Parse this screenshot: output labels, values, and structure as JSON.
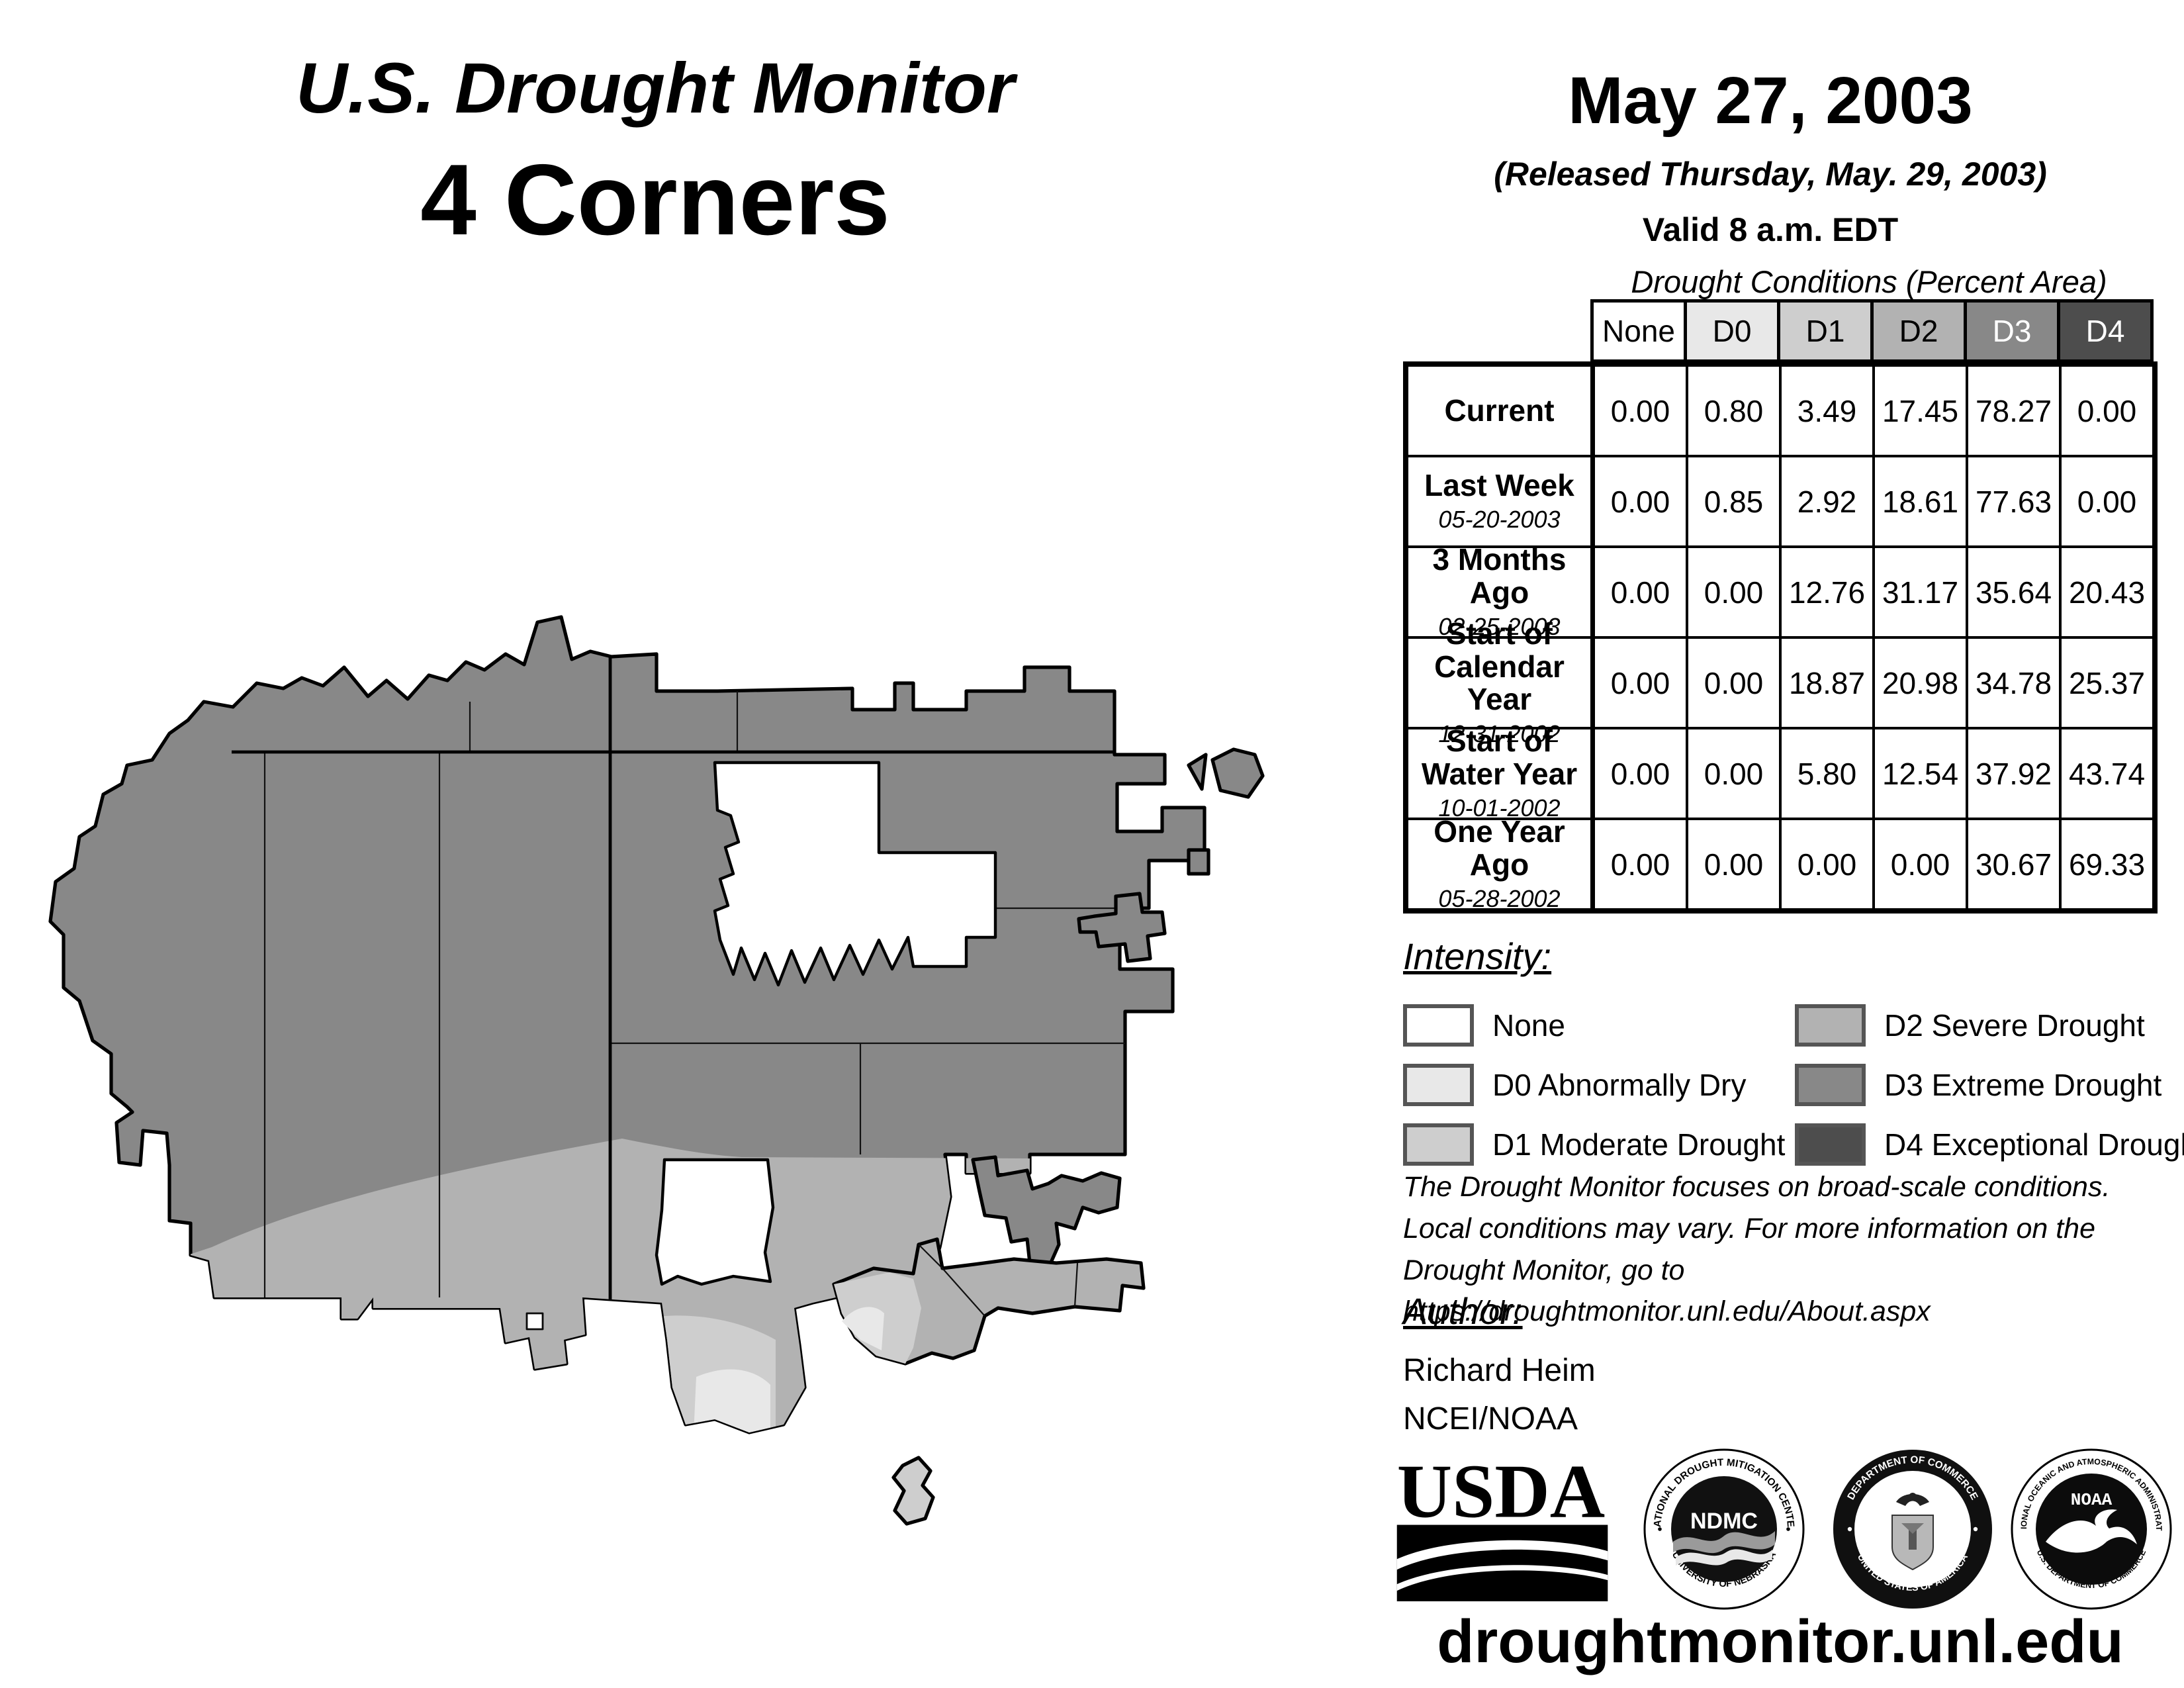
{
  "title": {
    "line1": "U.S. Drought Monitor",
    "line2": "4 Corners"
  },
  "date": {
    "main": "May 27, 2003",
    "released": "(Released Thursday, May. 29, 2003)",
    "valid": "Valid 8 a.m. EDT"
  },
  "table": {
    "title": "Drought Conditions (Percent Area)",
    "columns": [
      "None",
      "D0",
      "D1",
      "D2",
      "D3",
      "D4"
    ],
    "column_styles": [
      {
        "bg": "#ffffff",
        "fg": "#000000"
      },
      {
        "bg": "#e8e8e8",
        "fg": "#000000"
      },
      {
        "bg": "#cecece",
        "fg": "#000000"
      },
      {
        "bg": "#b2b2b2",
        "fg": "#000000"
      },
      {
        "bg": "#888888",
        "fg": "#ffffff"
      },
      {
        "bg": "#4d4d4d",
        "fg": "#ffffff"
      }
    ],
    "rows": [
      {
        "label": "Current",
        "date": "",
        "values": [
          "0.00",
          "0.80",
          "3.49",
          "17.45",
          "78.27",
          "0.00"
        ]
      },
      {
        "label": "Last Week",
        "date": "05-20-2003",
        "values": [
          "0.00",
          "0.85",
          "2.92",
          "18.61",
          "77.63",
          "0.00"
        ]
      },
      {
        "label": "3 Months Ago",
        "date": "02-25-2003",
        "values": [
          "0.00",
          "0.00",
          "12.76",
          "31.17",
          "35.64",
          "20.43"
        ]
      },
      {
        "label": "Start of Calendar Year",
        "date": "12-31-2002",
        "values": [
          "0.00",
          "0.00",
          "18.87",
          "20.98",
          "34.78",
          "25.37"
        ]
      },
      {
        "label": "Start of Water Year",
        "date": "10-01-2002",
        "values": [
          "0.00",
          "0.00",
          "5.80",
          "12.54",
          "37.92",
          "43.74"
        ]
      },
      {
        "label": "One Year Ago",
        "date": "05-28-2002",
        "values": [
          "0.00",
          "0.00",
          "0.00",
          "0.00",
          "30.67",
          "69.33"
        ]
      }
    ]
  },
  "legend": {
    "heading": "Intensity:",
    "items": [
      {
        "label": "None",
        "color": "#ffffff"
      },
      {
        "label": "D0 Abnormally Dry",
        "color": "#e8e8e8"
      },
      {
        "label": "D1 Moderate Drought",
        "color": "#cecece"
      },
      {
        "label": "D2 Severe Drought",
        "color": "#b2b2b2"
      },
      {
        "label": "D3 Extreme Drought",
        "color": "#888888"
      },
      {
        "label": "D4 Exceptional Drought",
        "color": "#4d4d4d"
      }
    ]
  },
  "colors": {
    "none": "#ffffff",
    "d0": "#e8e8e8",
    "d1": "#cecece",
    "d2": "#b2b2b2",
    "d3": "#888888",
    "d4": "#4d4d4d",
    "chip_border": "#555555"
  },
  "disclaimer": [
    "The Drought Monitor focuses on broad-scale conditions.",
    "Local conditions may vary. For more information on the",
    "Drought Monitor, go to https://droughtmonitor.unl.edu/About.aspx"
  ],
  "author": {
    "heading": "Author:",
    "name": "Richard Heim",
    "org": "NCEI/NOAA"
  },
  "logos": [
    {
      "name": "USDA",
      "label": "USDA"
    },
    {
      "name": "National Drought Mitigation Center",
      "label": "NDMC",
      "ring_top": "NATIONAL DROUGHT MITIGATION CENTER",
      "ring_bottom": "UNIVERSITY OF NEBRASKA"
    },
    {
      "name": "Department of Commerce",
      "ring_top": "DEPARTMENT OF COMMERCE",
      "ring_bottom": "UNITED STATES OF AMERICA"
    },
    {
      "name": "NOAA",
      "label": "NOAA",
      "ring_top": "NATIONAL OCEANIC AND ATMOSPHERIC ADMINISTRATION",
      "ring_bottom": "U.S. DEPARTMENT OF COMMERCE"
    }
  ],
  "footer": {
    "url": "droughtmonitor.unl.edu"
  }
}
